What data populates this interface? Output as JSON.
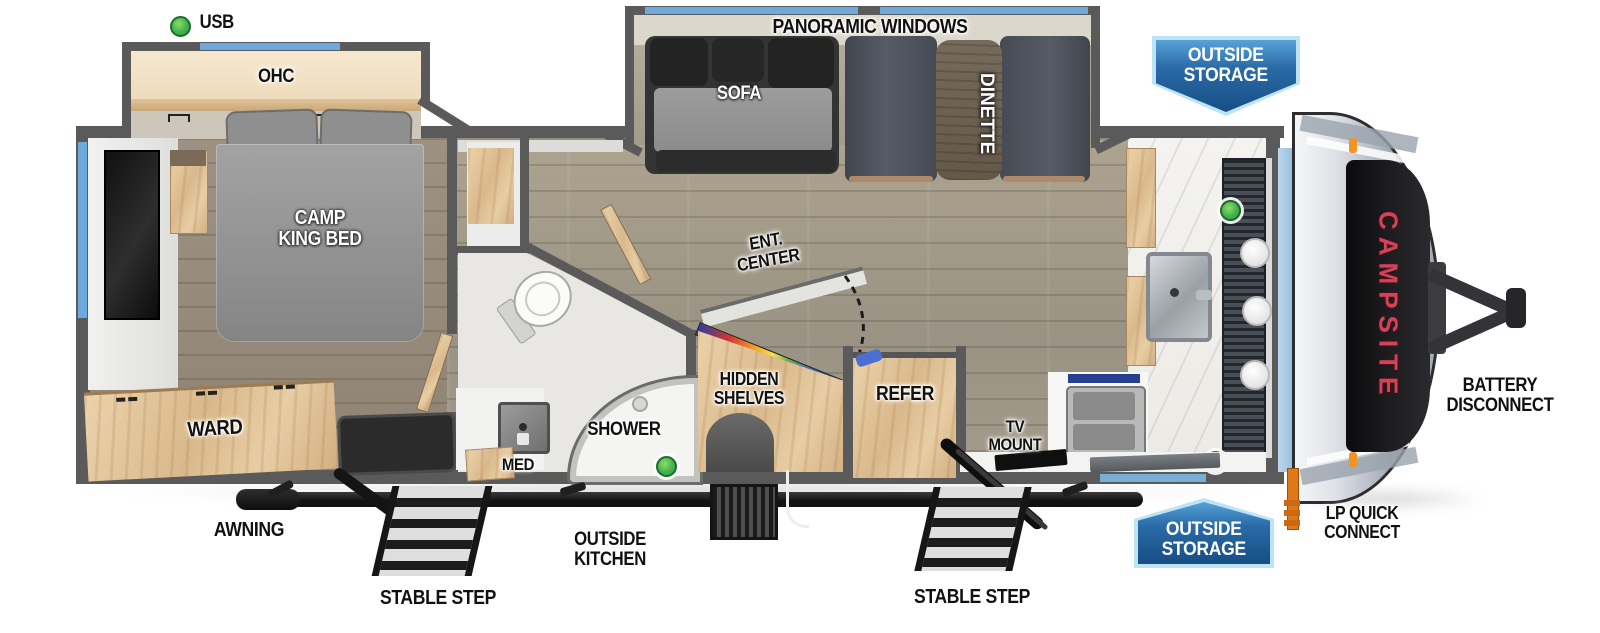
{
  "brand": "CAMPSITE",
  "labels": {
    "usb": "USB",
    "ohc": "OHC",
    "panoramic_windows": "PANORAMIC WINDOWS",
    "sofa": "SOFA",
    "dinette": "DINETTE",
    "camp_king_bed": "CAMP\nKING BED",
    "ward": "WARD",
    "ent_center": "ENT.\nCENTER",
    "hidden_shelves": "HIDDEN\nSHELVES",
    "refer": "REFER",
    "tv_mount": "TV\nMOUNT",
    "shower": "SHOWER",
    "med": "MED",
    "awning": "AWNING",
    "stable_step_left": "STABLE STEP",
    "stable_step_right": "STABLE STEP",
    "outside_kitchen": "OUTSIDE\nKITCHEN",
    "outside_storage_top": "OUTSIDE\nSTORAGE",
    "outside_storage_bottom": "OUTSIDE\nSTORAGE",
    "lp_quick_connect": "LP QUICK\nCONNECT",
    "battery_disconnect": "BATTERY\nDISCONNECT"
  },
  "indicators": {
    "usb_port_count": 4,
    "usb_port_color": "#3db549"
  },
  "colors": {
    "wall_gray": "#5a5a5a",
    "window_blue": "#6fa8dc",
    "banner_blue_dark": "#174e84",
    "banner_blue_light": "#56a3d6",
    "banner_border": "#bce4f6",
    "brand_red": "#cf4458",
    "lp_orange": "#e07818"
  }
}
